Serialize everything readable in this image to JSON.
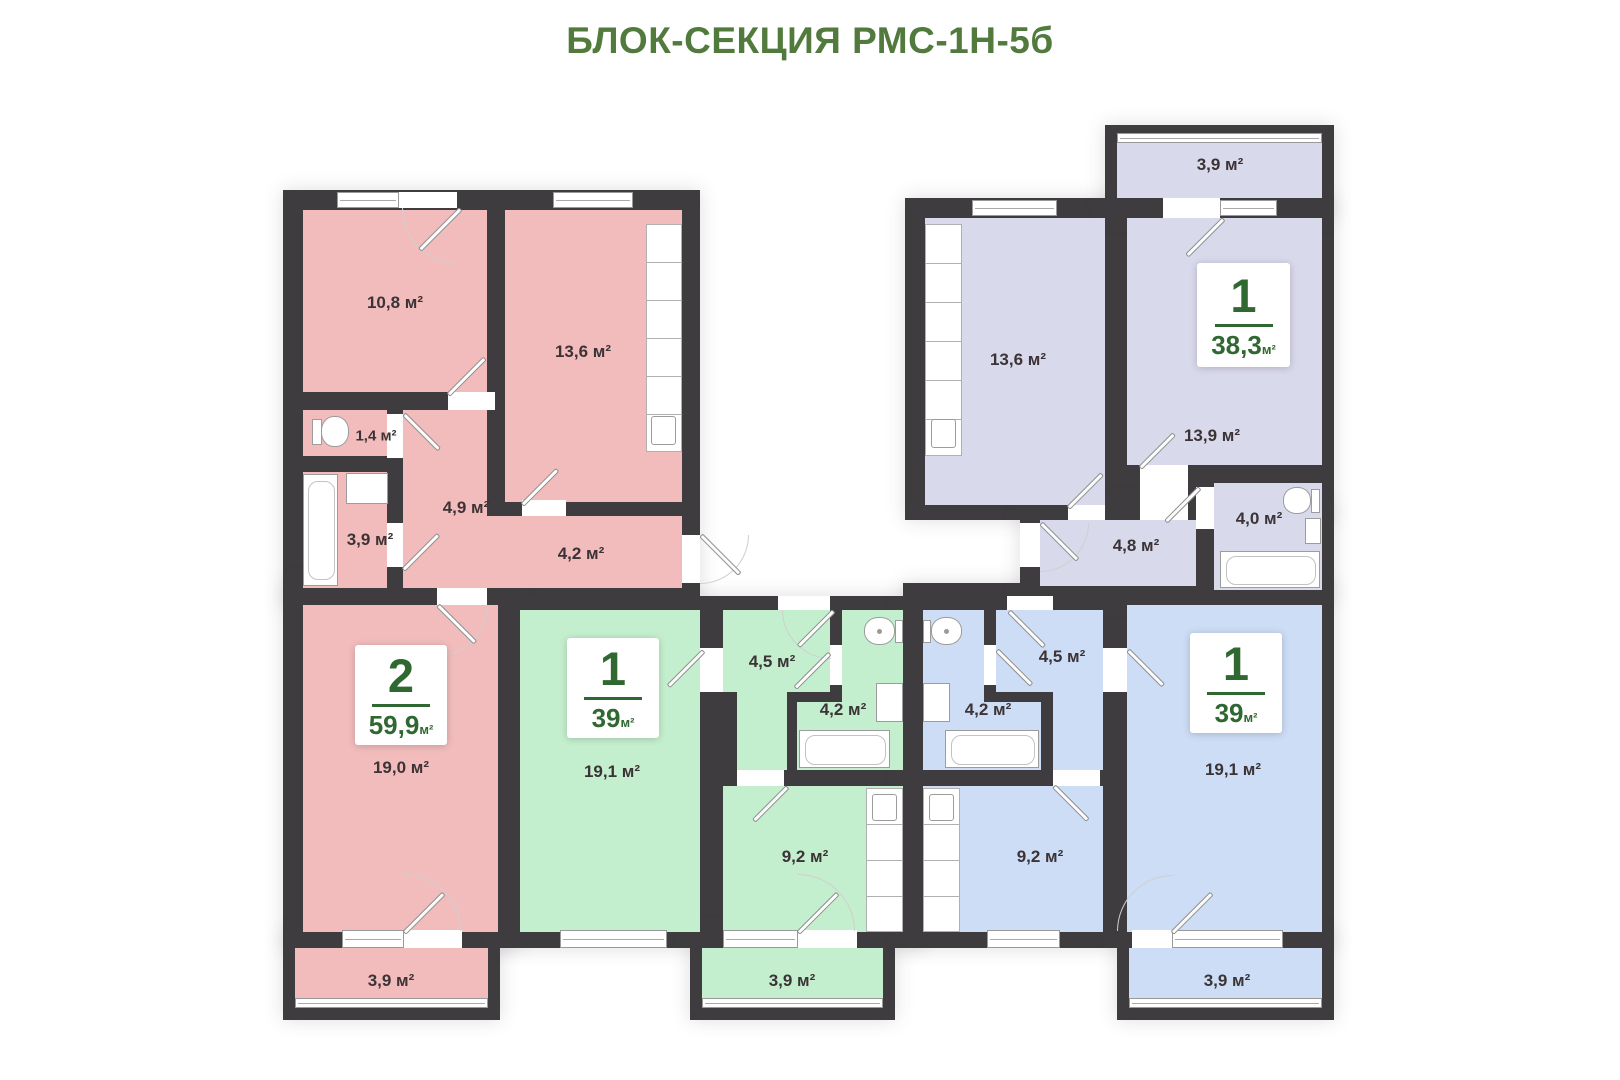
{
  "title": "БЛОК-СЕКЦИЯ РМС-1Н-5б",
  "units": {
    "pink": {
      "card": {
        "number": "2",
        "area": "59,9",
        "unit": "м²"
      },
      "rooms": {
        "room1": "10,8 м²",
        "kitchen": "13,6 м²",
        "wc": "1,4 м²",
        "bath": "3,9 м²",
        "hall": "4,9 м²",
        "corridor": "4,2 м²",
        "living": "19,0 м²",
        "balcony": "3,9 м²"
      }
    },
    "green": {
      "card": {
        "number": "1",
        "area": "39",
        "unit": "м²"
      },
      "rooms": {
        "living": "19,1 м²",
        "hall": "4,5 м²",
        "bath": "4,2 м²",
        "kitchen": "9,2 м²",
        "balcony": "3,9 м²"
      }
    },
    "blue": {
      "card": {
        "number": "1",
        "area": "39",
        "unit": "м²"
      },
      "rooms": {
        "hall": "4,5 м²",
        "bath": "4,2 м²",
        "kitchen": "9,2 м²",
        "living": "19,1 м²",
        "balcony": "3,9 м²"
      }
    },
    "lavender": {
      "card": {
        "number": "1",
        "area": "38,3",
        "unit": "м²"
      },
      "rooms": {
        "kitchen": "13,6 м²",
        "living": "13,9 м²",
        "bath": "4,0 м²",
        "hall": "4,8 м²",
        "balcony": "3,9 м²"
      }
    }
  },
  "colors": {
    "wall": "#3e3c3e",
    "pink": "#f2bcbc",
    "green": "#c4efce",
    "lavender": "#d9d9ec",
    "blue": "#ccddf5",
    "accent_green": "#527a3c",
    "card_green": "#2f6831"
  }
}
